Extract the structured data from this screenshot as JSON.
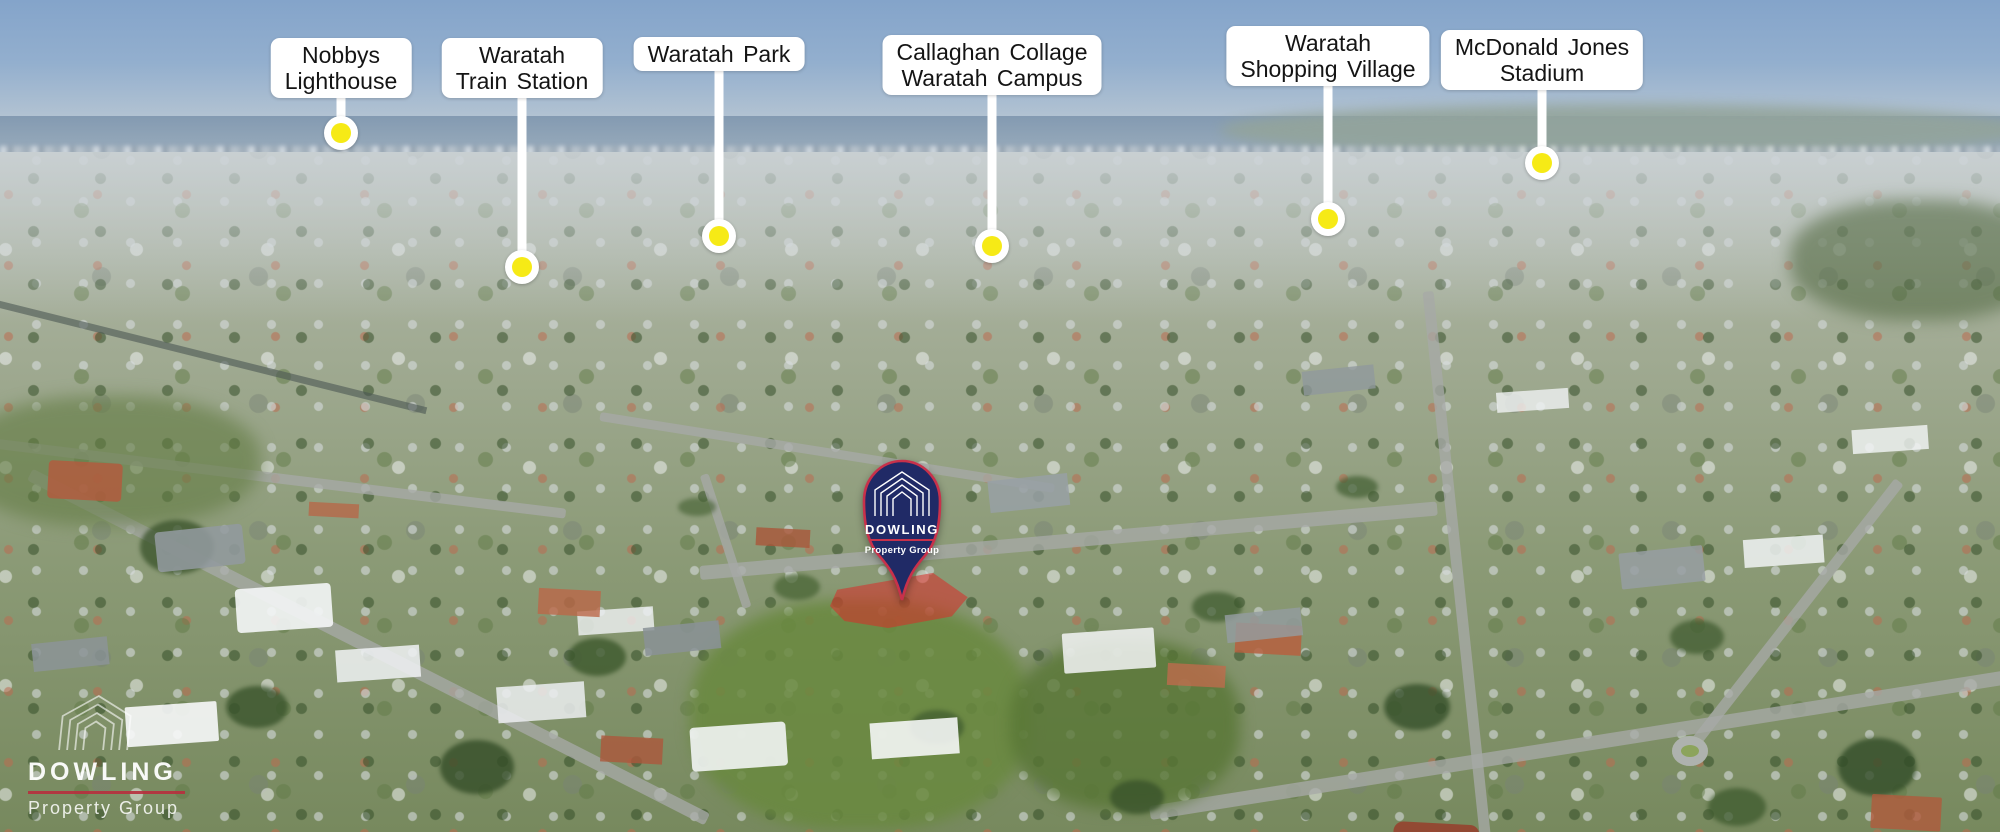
{
  "landmarks": [
    {
      "name": "Nobbys Lighthouse",
      "line1": "Nobbys",
      "line2": "Lighthouse"
    },
    {
      "name": "Waratah Train Station",
      "line1": "Waratah",
      "line2": "Train Station"
    },
    {
      "name": "Waratah Park",
      "line1": "Waratah Park",
      "line2": ""
    },
    {
      "name": "Callaghan Collage Waratah Campus",
      "line1": "Callaghan Collage",
      "line2": "Waratah Campus"
    },
    {
      "name": "Waratah Shopping Village",
      "line1": "Waratah",
      "line2": "Shopping Village"
    },
    {
      "name": "McDonald Jones Stadium",
      "line1": "McDonald Jones",
      "line2": "Stadium"
    }
  ],
  "property_pin": {
    "brand": "DOWLING",
    "sub": "Property Group"
  },
  "watermark": {
    "brand": "DOWLING",
    "sub": "Property Group"
  },
  "colors": {
    "marker_yellow": "#f6ea16",
    "pin_navy": "#202a66",
    "brand_red": "#c8314b",
    "label_bg": "#ffffff",
    "label_text": "#141414"
  }
}
